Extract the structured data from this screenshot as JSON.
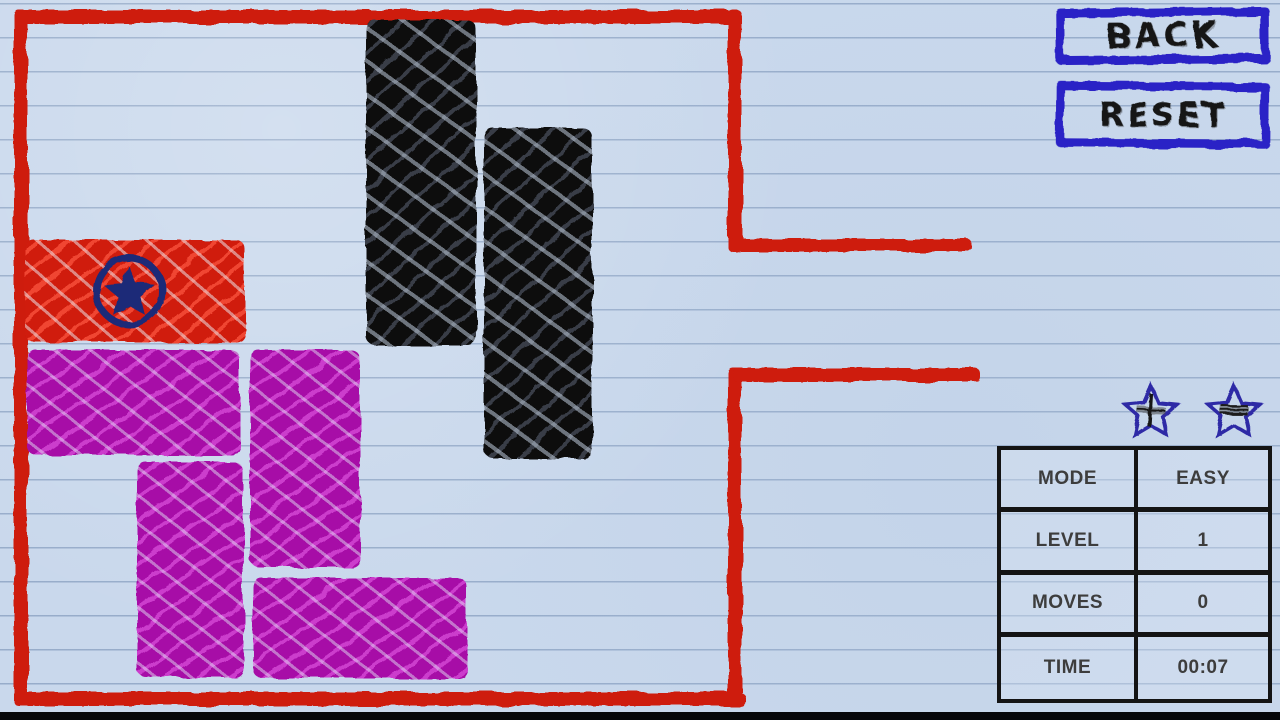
{
  "game": {
    "name": "doodle-block-puzzle",
    "bottom_bar": ""
  },
  "buttons": {
    "back": "BACK",
    "reset": "RESET"
  },
  "stars": {
    "star1": "star-plus",
    "star2": "star-lines"
  },
  "stats": {
    "rows": [
      {
        "label": "MODE",
        "value": "EASY"
      },
      {
        "label": "LEVEL",
        "value": "1"
      },
      {
        "label": "MOVES",
        "value": "0"
      },
      {
        "label": "TIME",
        "value": "00:07"
      }
    ]
  },
  "colors": {
    "paper": "#c9d8ec",
    "paper_line": "#7d96b9",
    "wall_red": "#ce1b10",
    "block_black": "#2b2e34",
    "block_magenta": "#c32cc5",
    "block_red": "#e6321f",
    "emblem_navy": "#1b2a78",
    "button_blue": "#2a23c6",
    "table_border": "#141414",
    "text_dark": "#3d3d3d"
  },
  "board": {
    "walls": [
      {
        "name": "wall-top",
        "style": "left:14px;top:10px;width:724px;height:14px"
      },
      {
        "name": "wall-left",
        "style": "left:14px;top:10px;width:14px;height:696px"
      },
      {
        "name": "wall-bottom",
        "style": "left:14px;top:692px;width:731px;height:14px"
      },
      {
        "name": "wall-right-upper",
        "style": "left:728px;top:10px;width:14px;height:242px"
      },
      {
        "name": "wall-right-lower",
        "style": "left:728px;top:368px;width:14px;height:338px"
      },
      {
        "name": "exit-lane-top",
        "style": "left:728px;top:239px;width:244px;height:13px"
      },
      {
        "name": "exit-lane-bottom",
        "style": "left:733px;top:368px;width:247px;height:14px"
      }
    ],
    "blocks": [
      {
        "name": "black-block-1",
        "type": "black",
        "style": "left:366px;top:20px;width:110px;height:325px"
      },
      {
        "name": "black-block-2",
        "type": "black",
        "style": "left:484px;top:128px;width:108px;height:330px"
      },
      {
        "name": "target-block",
        "type": "red",
        "style": "left:25px;top:240px;width:220px;height:102px"
      },
      {
        "name": "magenta-block-1",
        "type": "magenta",
        "style": "left:27px;top:350px;width:213px;height:105px"
      },
      {
        "name": "magenta-block-2",
        "type": "magenta",
        "style": "left:250px;top:350px;width:110px;height:217px"
      },
      {
        "name": "magenta-block-3",
        "type": "magenta",
        "style": "left:137px;top:462px;width:106px;height:215px"
      },
      {
        "name": "magenta-block-4",
        "type": "magenta",
        "style": "left:253px;top:578px;width:214px;height:100px"
      }
    ]
  }
}
